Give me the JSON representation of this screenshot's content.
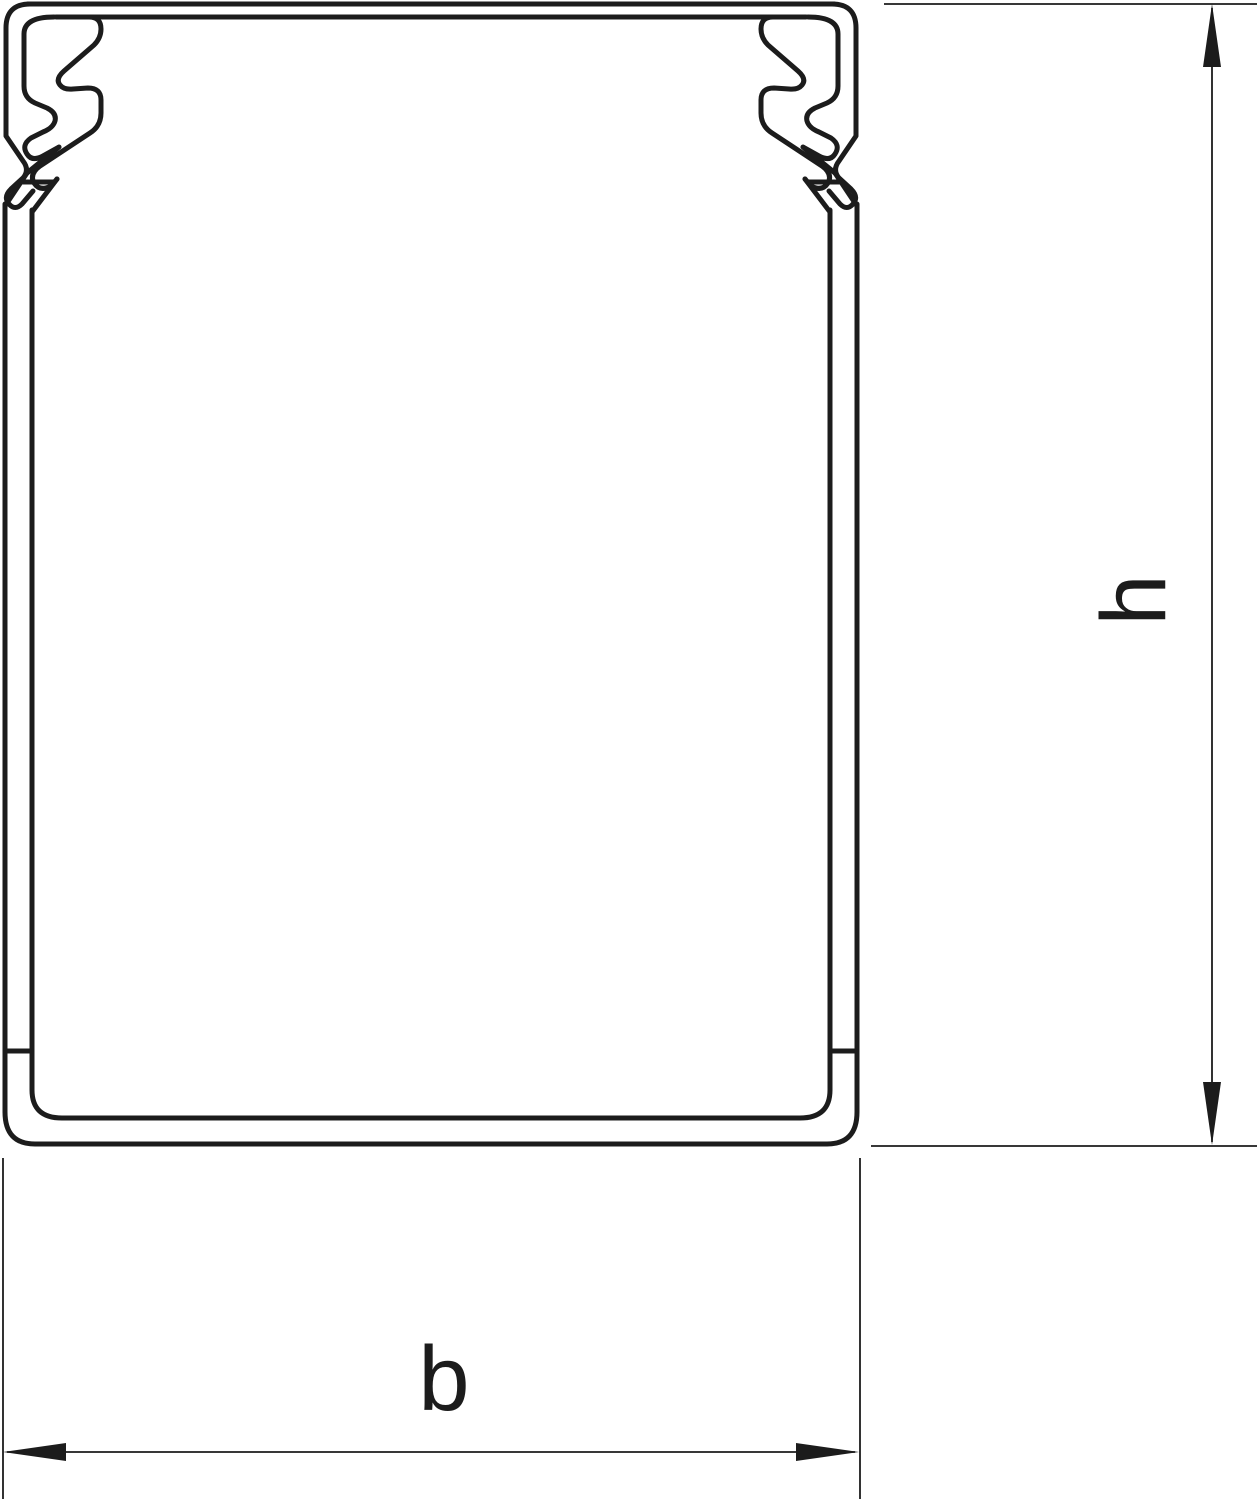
{
  "drawing": {
    "title": "cable-trunking-cross-section",
    "labels": {
      "height": "h",
      "width": "b"
    },
    "colors": {
      "line": "#1c1c1c",
      "background": "#ffffff"
    }
  }
}
